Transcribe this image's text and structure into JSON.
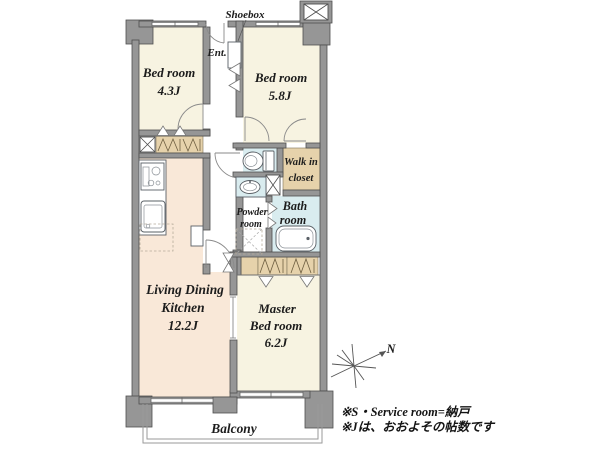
{
  "floorplan": {
    "rooms": {
      "bedroom1": {
        "name": "Bed room",
        "size": "4.3J"
      },
      "bedroom2": {
        "name": "Bed room",
        "size": "5.8J"
      },
      "walk_in_closet": {
        "line1": "Walk in",
        "line2": "closet"
      },
      "powder_room": {
        "line1": "Powder",
        "line2": "room"
      },
      "bath_room": {
        "line1": "Bath",
        "line2": "room"
      },
      "ldk": {
        "line1": "Living Dining",
        "line2": "Kitchen",
        "size": "12.2J"
      },
      "master_bedroom": {
        "line1": "Master",
        "line2": "Bed room",
        "size": "6.2J"
      },
      "balcony": "Balcony"
    },
    "labels": {
      "shoebox": "Shoebox",
      "entrance": "Ent.",
      "north": "N"
    },
    "footnotes": {
      "line1": "※S・Service room=納戸",
      "line2": "※Jは、おおよその帖数です"
    },
    "icons": {
      "pipe_shaft": "box-with-x",
      "closet_hanger": "zigzag",
      "compass": "star-burst-north-arrow",
      "washer_space": "dashed-box-with-x"
    },
    "colors": {
      "wall": "#969696",
      "wall_outline": "#4e4e4e",
      "bedroom": "#f7f3e1",
      "ldk": "#f9e8d8",
      "wet_area": "#d9ecef",
      "closet": "#e6d2ab"
    }
  }
}
